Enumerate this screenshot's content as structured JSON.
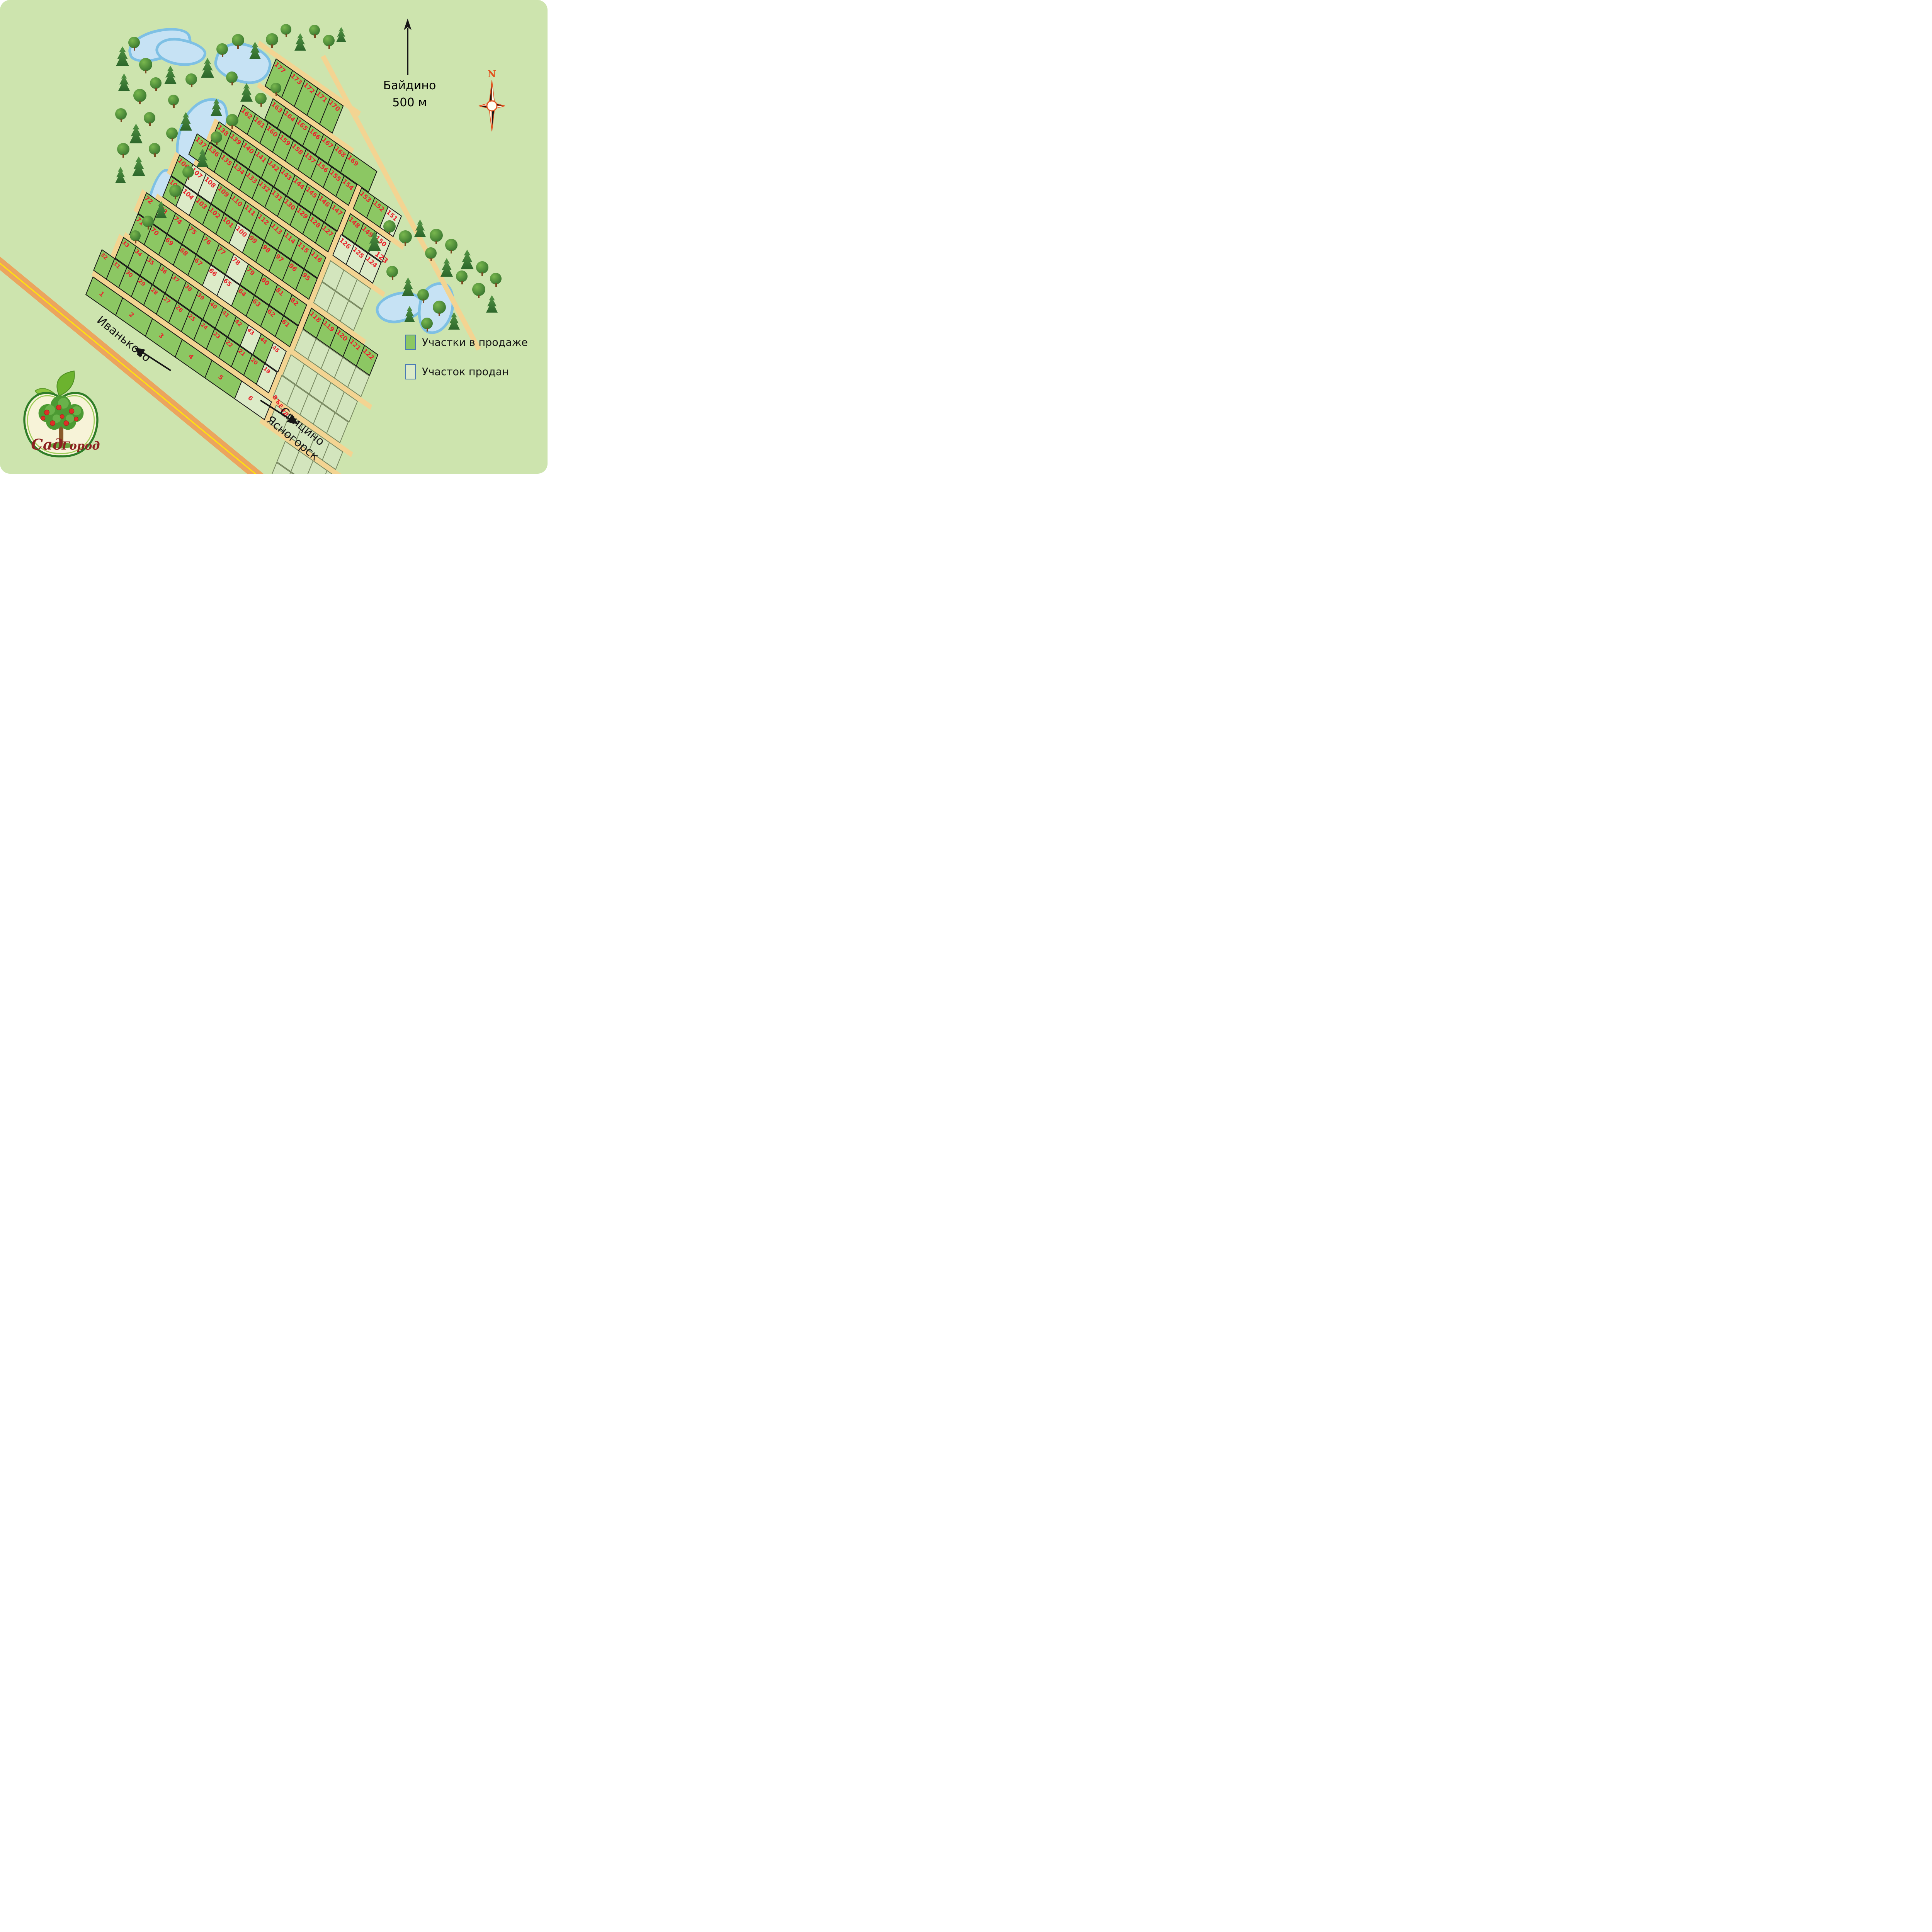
{
  "map": {
    "title_hidden": "",
    "compass": {
      "north": "N"
    },
    "destination": {
      "name": "Байдино",
      "distance": "500 м"
    },
    "roads": {
      "left": "Иваньково",
      "right_line1": "Спицино",
      "right_line2": "Ясногорск",
      "entrance": "ВЪЕЗД"
    },
    "external_plot_label": "123",
    "legend": {
      "for_sale": "Участки в продаже",
      "sold": "Участок продан"
    },
    "logo": {
      "word_left": "Сад",
      "word_right": "Город"
    },
    "colors": {
      "background": "#cde4ae",
      "plot_for_sale": "#8cc763",
      "plot_sold": "#dcebc8",
      "sold_area": "#d3e5bd",
      "inner_road": "#f3d492",
      "main_road": "#eba55e",
      "number_red": "#e8262d",
      "legend_border": "#4a7ab5",
      "pond": "#c6e2f4"
    },
    "rows": {
      "r1": {
        "cells": [
          {
            "n": "177"
          },
          {
            "n": "173"
          },
          {
            "n": "172"
          },
          {
            "n": "171"
          },
          {
            "n": "170"
          }
        ]
      },
      "r2t": {
        "cells": [
          {
            "n": "163"
          },
          {
            "n": "164"
          },
          {
            "n": "165"
          },
          {
            "n": "166"
          },
          {
            "n": "167"
          },
          {
            "n": "168"
          },
          {
            "n": "169"
          }
        ]
      },
      "r2b": {
        "cells": [
          {
            "n": "162"
          },
          {
            "n": "161"
          },
          {
            "n": "160"
          },
          {
            "n": "159"
          },
          {
            "n": "158"
          },
          {
            "n": "157"
          },
          {
            "n": "156"
          },
          {
            "n": "155"
          },
          {
            "n": "154"
          }
        ],
        "after": [
          {
            "n": "153"
          },
          {
            "n": "152"
          },
          {
            "n": "151",
            "sold": true
          }
        ]
      },
      "r3t": {
        "cells": [
          {
            "n": "138"
          },
          {
            "n": "139"
          },
          {
            "n": "140"
          },
          {
            "n": "141"
          },
          {
            "n": "142"
          },
          {
            "n": "143"
          },
          {
            "n": "144"
          },
          {
            "n": "145"
          },
          {
            "n": "146"
          },
          {
            "n": "147"
          }
        ],
        "after": [
          {
            "n": "148"
          },
          {
            "n": "149"
          },
          {
            "n": "150",
            "sold": true
          }
        ]
      },
      "r3b": {
        "cells": [
          {
            "n": "137"
          },
          {
            "n": "136"
          },
          {
            "n": "135"
          },
          {
            "n": "134"
          },
          {
            "n": "133"
          },
          {
            "n": "132"
          },
          {
            "n": "131"
          },
          {
            "n": "130"
          },
          {
            "n": "129"
          },
          {
            "n": "128"
          },
          {
            "n": "127"
          }
        ],
        "after": [
          {
            "n": "126",
            "sold": true
          },
          {
            "n": "125",
            "sold": true
          },
          {
            "n": "124",
            "sold": true
          }
        ]
      },
      "r4t": {
        "cells": [
          {
            "n": "106"
          },
          {
            "n": "107",
            "sold": true
          },
          {
            "n": "108",
            "sold": true
          },
          {
            "n": "109"
          },
          {
            "n": "110"
          },
          {
            "n": "111"
          },
          {
            "n": "112"
          },
          {
            "n": "113"
          },
          {
            "n": "114"
          },
          {
            "n": "115"
          },
          {
            "n": "116"
          }
        ],
        "after": [
          {
            "gray": true
          },
          {
            "gray": true
          },
          {
            "gray": true
          }
        ]
      },
      "r4b": {
        "cells": [
          {
            "n": "105"
          },
          {
            "n": "104",
            "sold": true
          },
          {
            "n": "103"
          },
          {
            "n": "102"
          },
          {
            "n": "101"
          },
          {
            "n": "100",
            "sold": true
          },
          {
            "n": "99"
          },
          {
            "n": "98"
          },
          {
            "n": "97"
          },
          {
            "n": "96"
          },
          {
            "n": "95"
          }
        ],
        "after": [
          {
            "gray": true
          },
          {
            "gray": true
          },
          {
            "gray": true
          }
        ]
      },
      "r5t": {
        "cells": [
          {
            "n": "72"
          },
          {
            "n": "73"
          },
          {
            "n": "74"
          },
          {
            "n": "75"
          },
          {
            "n": "76"
          },
          {
            "n": "77"
          },
          {
            "n": "78",
            "sold": true
          },
          {
            "n": "79"
          },
          {
            "n": "80"
          },
          {
            "n": "81"
          },
          {
            "n": "82"
          }
        ],
        "after": [
          {
            "n": "118"
          },
          {
            "n": "119"
          },
          {
            "n": "120"
          },
          {
            "n": "121"
          },
          {
            "n": "122"
          }
        ]
      },
      "r5b": {
        "cells": [
          {
            "n": "71"
          },
          {
            "n": "70"
          },
          {
            "n": "69"
          },
          {
            "n": "68"
          },
          {
            "n": "67"
          },
          {
            "n": "66",
            "sold": true
          },
          {
            "n": "65",
            "sold": true
          },
          {
            "n": "64"
          },
          {
            "n": "63"
          },
          {
            "n": "62"
          },
          {
            "n": "61"
          }
        ],
        "after": [
          {
            "gray": true
          },
          {
            "gray": true
          },
          {
            "gray": true
          },
          {
            "gray": true
          },
          {
            "gray": true
          }
        ]
      },
      "r6t": {
        "cells": [
          {
            "n": "33"
          },
          {
            "n": "34"
          },
          {
            "n": "35"
          },
          {
            "n": "36"
          },
          {
            "n": "37"
          },
          {
            "n": "38"
          },
          {
            "n": "39"
          },
          {
            "n": "40"
          },
          {
            "n": "41"
          },
          {
            "n": "42"
          },
          {
            "n": "43",
            "sold": true
          },
          {
            "n": "44"
          },
          {
            "n": "45",
            "sold": true
          }
        ],
        "after": [
          {
            "gray": true
          },
          {
            "gray": true
          },
          {
            "gray": true
          },
          {
            "gray": true
          },
          {
            "gray": true
          }
        ]
      },
      "r6b": {
        "cells": [
          {
            "n": "32"
          },
          {
            "n": "31"
          },
          {
            "n": "30"
          },
          {
            "n": "29"
          },
          {
            "n": "28"
          },
          {
            "n": "27"
          },
          {
            "n": "26"
          },
          {
            "n": "25"
          },
          {
            "n": "24"
          },
          {
            "n": "23"
          },
          {
            "n": "22"
          },
          {
            "n": "21"
          },
          {
            "n": "20"
          },
          {
            "n": "19",
            "sold": true
          }
        ],
        "after": [
          {
            "gray": true
          },
          {
            "gray": true
          },
          {
            "gray": true
          },
          {
            "gray": true
          },
          {
            "gray": true
          }
        ]
      },
      "r7": {
        "cells": [
          {
            "n": "1"
          },
          {
            "n": "2"
          },
          {
            "n": "3"
          },
          {
            "n": "4"
          },
          {
            "n": "5"
          },
          {
            "n": "6",
            "sold": true
          }
        ],
        "after": [
          {
            "gray": true
          },
          {
            "gray": true
          },
          {
            "gray": true
          },
          {
            "gray": true
          },
          {
            "gray": true
          }
        ]
      },
      "r8t": {
        "cells": [
          {
            "gray": true
          },
          {
            "gray": true
          },
          {
            "gray": true
          },
          {
            "gray": true
          }
        ]
      },
      "r8b": {
        "cells": [
          {
            "gray": true
          },
          {
            "gray": true
          },
          {
            "gray": true
          },
          {
            "gray": true
          }
        ]
      },
      "r9t": {
        "cells": [
          {
            "gray": true
          },
          {
            "gray": true
          },
          {
            "gray": true
          }
        ]
      }
    }
  }
}
